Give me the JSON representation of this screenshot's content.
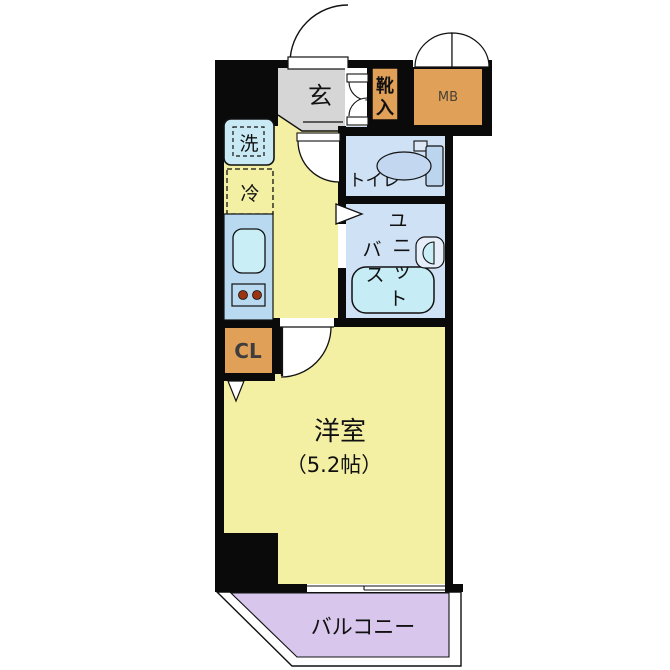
{
  "plan": {
    "type": "apartment-floorplan",
    "rooms": {
      "genkan": {
        "label": "玄"
      },
      "shoe_cabinet": {
        "label": "靴入",
        "chars": [
          "靴",
          "入"
        ]
      },
      "meter_box": {
        "label": "MB"
      },
      "washer": {
        "label": "洗"
      },
      "fridge": {
        "label": "冷"
      },
      "toilet": {
        "label": "トイレ"
      },
      "unit_bath": {
        "label": "ユニットバス",
        "chars": [
          "ユ",
          "ニ",
          "ッ",
          "ト",
          "バ",
          "ス"
        ]
      },
      "closet": {
        "label": "CL"
      },
      "western_room": {
        "label": "洋室",
        "size": "（5.2帖）"
      },
      "balcony": {
        "label": "バルコニー"
      }
    },
    "colors": {
      "wall": "#0a0a0a",
      "floor_yellow": "#f3f0a3",
      "genkan_gray": "#d6d6d6",
      "wet_area_blue": "#cfe1f5",
      "counter_blue": "#b8d9f0",
      "sink_cyan": "#c9eef6",
      "tub_cyan": "#c6edf6",
      "cabinet_orange": "#e0a057",
      "balcony_purple": "#d8c6ed",
      "toilet_bowl_blue": "#c3d8f0"
    }
  }
}
